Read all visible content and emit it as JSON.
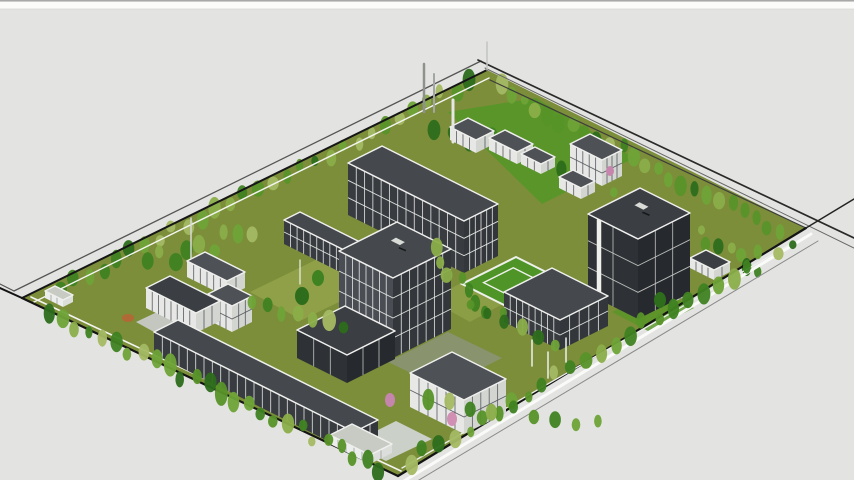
{
  "canvas": {
    "width": 854,
    "height": 480,
    "background": "#e3e4e1"
  },
  "topbar": {
    "height": 9,
    "fill": "#fbfbfa",
    "line": "#9c9c9c",
    "edge": "#d6d6d4"
  },
  "palette": {
    "boundary_black": "#141414",
    "road_gray": "#555555",
    "fence_white": "#f4f5f2",
    "roof_charcoal": "#45484d",
    "glazing_dark": "#383b40",
    "mullion_white": "#edefec",
    "lawn_olive": "#7c8e3a",
    "lawn_bright": "#579628",
    "lawn_light": "#9aab50",
    "pavement": "#c3c7c0",
    "plaza": "#cbd0c8",
    "tree_pink": "#c585ad",
    "tree_orange": "#b06a35"
  },
  "scene": {
    "site": {
      "outline": [
        [
          487,
          70
        ],
        [
          806,
          228
        ],
        [
          398,
          476
        ],
        [
          22,
          298
        ]
      ],
      "fill": "#7c8e3a",
      "bright": "#4f9427"
    },
    "tree_colors": [
      "#2d6d1b",
      "#3f8221",
      "#579428",
      "#6fa337",
      "#8bae49",
      "#a4b963"
    ],
    "styles": {
      "glass": {
        "roof": "#45484d",
        "wallL": "#383b40",
        "wallR": "#33363b",
        "line": "#edefec"
      },
      "dark": {
        "roof": "#3b3e43",
        "wallL": "#2e3136",
        "wallR": "#26292e",
        "line": "#c9cbc7"
      },
      "white": {
        "roof": "#4e5156",
        "wallL": "#e7e8e5",
        "wallR": "#d3d5d1",
        "line": "#50535a"
      },
      "light": {
        "roof": "#c7cbc4",
        "wallL": "#eceded",
        "wallR": "#dcdedb",
        "line": "#9a9e97"
      }
    },
    "patches": [
      {
        "name": "lawn-north-bright",
        "points": [
          [
            448,
            112
          ],
          [
            536,
            98
          ],
          [
            634,
            158
          ],
          [
            542,
            204
          ]
        ],
        "fill": "#579628",
        "opacity": 0.9
      },
      {
        "name": "lawn-west-light",
        "points": [
          [
            250,
            292
          ],
          [
            332,
            252
          ],
          [
            384,
            280
          ],
          [
            302,
            320
          ]
        ],
        "fill": "#9aab50",
        "opacity": 0.65
      },
      {
        "name": "lawn-mid-light",
        "points": [
          [
            430,
            300
          ],
          [
            470,
            278
          ],
          [
            510,
            300
          ],
          [
            470,
            322
          ]
        ],
        "fill": "#9aab50",
        "opacity": 0.5
      },
      {
        "name": "court-gray",
        "points": [
          [
            388,
            362
          ],
          [
            448,
            332
          ],
          [
            502,
            358
          ],
          [
            442,
            388
          ]
        ],
        "fill": "#8e947f",
        "opacity": 0.75
      },
      {
        "name": "plaza-south",
        "points": [
          [
            350,
            444
          ],
          [
            396,
            421
          ],
          [
            432,
            439
          ],
          [
            386,
            461
          ]
        ],
        "fill": "#cbd0c8",
        "opacity": 1
      },
      {
        "name": "pavement-west",
        "points": [
          [
            136,
            322
          ],
          [
            174,
            304
          ],
          [
            210,
            324
          ],
          [
            174,
            343
          ]
        ],
        "fill": "#c3c7c0",
        "opacity": 1
      },
      {
        "name": "lawn-east-bright",
        "points": [
          [
            612,
            312
          ],
          [
            658,
            288
          ],
          [
            694,
            308
          ],
          [
            648,
            331
          ]
        ],
        "fill": "#579628",
        "opacity": 0.8
      }
    ],
    "boundary": [
      {
        "name": "nw-road-outer",
        "pts": [
          [
            14,
            291
          ],
          [
            481,
            61
          ]
        ],
        "c": "#555555",
        "w": 1.3
      },
      {
        "name": "nw-fence",
        "pts": [
          [
            22,
            298
          ],
          [
            487,
            70
          ]
        ],
        "c": "#161616",
        "w": 2
      },
      {
        "name": "nw-fence-inner",
        "pts": [
          [
            32,
            303
          ],
          [
            489,
            78
          ]
        ],
        "c": "#f4f5f2",
        "w": 1.4
      },
      {
        "name": "ne-road-outer",
        "pts": [
          [
            478,
            60
          ],
          [
            854,
            238
          ]
        ],
        "c": "#2a2a2a",
        "w": 1.7
      },
      {
        "name": "ne-road-inner",
        "pts": [
          [
            485,
            68
          ],
          [
            854,
            248
          ]
        ],
        "c": "#666666",
        "w": 1
      },
      {
        "name": "ne-fence",
        "pts": [
          [
            490,
            80
          ],
          [
            806,
            228
          ]
        ],
        "c": "#3d3d3d",
        "w": 1.2
      },
      {
        "name": "se-fence",
        "pts": [
          [
            806,
            228
          ],
          [
            398,
            476
          ]
        ],
        "c": "#141414",
        "w": 2.2
      },
      {
        "name": "se-road-white",
        "pts": [
          [
            811,
            234
          ],
          [
            404,
            481
          ]
        ],
        "c": "#fafaf8",
        "w": 3
      },
      {
        "name": "se-road-outer",
        "pts": [
          [
            818,
            241
          ],
          [
            414,
            483
          ]
        ],
        "c": "#8a8a8a",
        "w": 1
      },
      {
        "name": "se-extension",
        "pts": [
          [
            806,
            228
          ],
          [
            854,
            199
          ]
        ],
        "c": "#222222",
        "w": 1.4
      },
      {
        "name": "sw-fence",
        "pts": [
          [
            22,
            298
          ],
          [
            398,
            476
          ]
        ],
        "c": "#141414",
        "w": 2.2
      },
      {
        "name": "sw-fence-inner",
        "pts": [
          [
            31,
            297
          ],
          [
            401,
            471
          ]
        ],
        "c": "#f4f5f2",
        "w": 1.6
      },
      {
        "name": "sw-extension",
        "pts": [
          [
            22,
            298
          ],
          [
            0,
            288
          ]
        ],
        "c": "#141414",
        "w": 2
      },
      {
        "name": "nw-ext-left",
        "pts": [
          [
            14,
            291
          ],
          [
            0,
            284
          ]
        ],
        "c": "#555555",
        "w": 1.2
      },
      {
        "name": "se-inner-path",
        "pts": [
          [
            796,
            241
          ],
          [
            402,
            468
          ]
        ],
        "c": "#eef0ec",
        "w": 1.3
      }
    ],
    "belts_back": [
      {
        "name": "belt-northwest",
        "x1": 60,
        "y1": 288,
        "x2": 470,
        "y2": 82,
        "n": 30,
        "j": 6,
        "rmin": 3.5,
        "rmax": 6.5,
        "seed": 11
      },
      {
        "name": "belt-northeast",
        "x1": 500,
        "y1": 88,
        "x2": 780,
        "y2": 232,
        "n": 24,
        "j": 6,
        "rmin": 3.5,
        "rmax": 6.5,
        "seed": 23
      },
      {
        "name": "grove-west",
        "x1": 148,
        "y1": 262,
        "x2": 252,
        "y2": 234,
        "n": 9,
        "j": 10,
        "rmin": 4,
        "rmax": 7,
        "seed": 31
      },
      {
        "name": "grove-north-lawn",
        "x1": 436,
        "y1": 124,
        "x2": 616,
        "y2": 186,
        "n": 11,
        "j": 9,
        "rmin": 3.5,
        "rmax": 6.5,
        "seed": 41
      },
      {
        "name": "grove-east",
        "x1": 700,
        "y1": 232,
        "x2": 756,
        "y2": 274,
        "n": 7,
        "j": 7,
        "rmin": 3.5,
        "rmax": 6.5,
        "seed": 53
      }
    ],
    "belts_front": [
      {
        "name": "belt-southwest",
        "x1": 50,
        "y1": 312,
        "x2": 380,
        "y2": 468,
        "n": 26,
        "j": 6,
        "rmin": 3.5,
        "rmax": 6.5,
        "seed": 61
      },
      {
        "name": "belt-southeast",
        "x1": 790,
        "y1": 240,
        "x2": 410,
        "y2": 462,
        "n": 27,
        "j": 6,
        "rmin": 3.5,
        "rmax": 6.5,
        "seed": 71
      },
      {
        "name": "grove-west-front",
        "x1": 252,
        "y1": 302,
        "x2": 342,
        "y2": 332,
        "n": 7,
        "j": 8,
        "rmin": 4,
        "rmax": 7,
        "seed": 83
      },
      {
        "name": "grove-center",
        "x1": 432,
        "y1": 252,
        "x2": 498,
        "y2": 318,
        "n": 8,
        "j": 8,
        "rmin": 3.5,
        "rmax": 6.5,
        "seed": 97
      },
      {
        "name": "grove-south",
        "x1": 428,
        "y1": 402,
        "x2": 598,
        "y2": 420,
        "n": 9,
        "j": 7,
        "rmin": 3.5,
        "rmax": 6.5,
        "seed": 103
      },
      {
        "name": "grove-courtyard-south",
        "x1": 472,
        "y1": 302,
        "x2": 556,
        "y2": 344,
        "n": 6,
        "j": 7,
        "rmin": 3.5,
        "rmax": 6,
        "seed": 113
      }
    ],
    "singles": [
      {
        "name": "pink-tree-1",
        "x": 390,
        "y": 400,
        "rx": 5,
        "ry": 7,
        "color": "#c585ad"
      },
      {
        "name": "pink-tree-2",
        "x": 452,
        "y": 419,
        "rx": 5,
        "ry": 7,
        "color": "#d18fb4"
      },
      {
        "name": "pink-tree-3",
        "x": 610,
        "y": 171,
        "rx": 4,
        "ry": 5,
        "color": "#c585ad"
      },
      {
        "name": "orange-tree",
        "x": 128,
        "y": 318,
        "rx": 6,
        "ry": 4,
        "color": "#b06a35"
      },
      {
        "name": "dark-tree-1",
        "x": 302,
        "y": 296,
        "rx": 7,
        "ry": 9,
        "color": "#2d6d1b"
      },
      {
        "name": "dark-tree-2",
        "x": 318,
        "y": 278,
        "rx": 6,
        "ry": 8,
        "color": "#3f8221"
      },
      {
        "name": "dark-tree-3",
        "x": 660,
        "y": 300,
        "rx": 6,
        "ry": 8,
        "color": "#2d6d1b"
      }
    ],
    "buildings": [
      {
        "name": "building-north-shed-a",
        "x": 468,
        "y": 118,
        "a": 13,
        "b": 9,
        "h": 13,
        "s": "white",
        "fl": 1,
        "mL": 4,
        "mR": 2
      },
      {
        "name": "building-north-shed-b",
        "x": 505,
        "y": 130,
        "a": 14,
        "b": 8,
        "h": 12,
        "s": "white",
        "fl": 1,
        "mL": 4,
        "mR": 2
      },
      {
        "name": "building-north-shed-c",
        "x": 535,
        "y": 147,
        "a": 10,
        "b": 7,
        "h": 10,
        "s": "white",
        "fl": 1,
        "mL": 3,
        "mR": 2
      },
      {
        "name": "building-northeast-lab",
        "x": 590,
        "y": 134,
        "a": 16,
        "b": 10,
        "h": 26,
        "s": "white",
        "fl": 2,
        "mL": 5,
        "mR": 4
      },
      {
        "name": "building-northeast-shed",
        "x": 573,
        "y": 170,
        "a": 11,
        "b": 7,
        "h": 11,
        "s": "white",
        "fl": 1,
        "mL": 3,
        "mR": 2
      },
      {
        "name": "building-glass-corridor",
        "x": 300,
        "y": 212,
        "a": 36,
        "b": 8,
        "h": 24,
        "s": "glass",
        "fl": 2,
        "mL": 11,
        "mR": 2
      },
      {
        "name": "building-north-glass-slab",
        "x": 382,
        "y": 146,
        "a": 58,
        "b": 17,
        "h": 52,
        "s": "glass",
        "fl": 3,
        "mL": 14,
        "mR": 6
      },
      {
        "name": "building-west-north-wing",
        "x": 205,
        "y": 252,
        "a": 20,
        "b": 9,
        "h": 16,
        "s": "white",
        "fl": 1,
        "mL": 6,
        "mR": 2
      },
      {
        "name": "building-east-row-north",
        "x": 706,
        "y": 250,
        "a": 12,
        "b": 8,
        "h": 10,
        "s": "white",
        "fl": 1,
        "mL": 4,
        "mR": 2,
        "roof": "#3b3e43"
      },
      {
        "name": "building-west-gatehouse",
        "x": 55,
        "y": 286,
        "a": 9,
        "b": 5,
        "h": 7,
        "s": "light",
        "fl": 1,
        "mL": 3,
        "mR": 1
      },
      {
        "name": "building-east-row-south",
        "x": 664,
        "y": 272,
        "a": 12,
        "b": 8,
        "h": 11,
        "s": "white",
        "fl": 1,
        "mL": 3,
        "mR": 2,
        "roof": "#3b3e43"
      },
      {
        "name": "building-west-pavilion",
        "x": 228,
        "y": 284,
        "a": 12,
        "b": 10,
        "h": 26,
        "s": "white",
        "fl": 2,
        "mL": 4,
        "mR": 3
      },
      {
        "name": "building-west-colonnade",
        "x": 170,
        "y": 276,
        "a": 25,
        "b": 12,
        "h": 20,
        "s": "white",
        "fl": 1,
        "mL": 8,
        "mR": 3,
        "roof": "#3b3e43"
      },
      {
        "name": "building-east-tower",
        "x": 640,
        "y": 188,
        "a": 25,
        "b": 26,
        "h": 80,
        "s": "dark",
        "fl": 3,
        "mL": 2,
        "mR": 3,
        "stripe": 0.22,
        "vent": 1
      },
      {
        "name": "building-courtyard-pergola",
        "type": "frame",
        "x": 516,
        "y": 257,
        "a": 21,
        "b": 27
      },
      {
        "name": "building-courtyard-wing",
        "x": 552,
        "y": 268,
        "a": 28,
        "b": 24,
        "h": 30,
        "s": "glass",
        "fl": 2,
        "mL": 9,
        "mR": 5
      },
      {
        "name": "building-central-tower",
        "x": 397,
        "y": 222,
        "a": 27,
        "b": 29,
        "h": 80,
        "s": "glass",
        "fl": 4,
        "mL": 8,
        "mR": 7,
        "wl": "#4a4e54",
        "vent": 1
      },
      {
        "name": "building-south-dark-box",
        "x": 345,
        "y": 306,
        "a": 25,
        "b": 24,
        "h": 28,
        "s": "dark",
        "fl": 1,
        "mL": 3,
        "mR": 3
      },
      {
        "name": "building-south-house",
        "x": 452,
        "y": 352,
        "a": 27,
        "b": 21,
        "h": 34,
        "s": "white",
        "fl": 2,
        "mL": 6,
        "mR": 5
      },
      {
        "name": "building-southwest-colonnade",
        "x": 178,
        "y": 320,
        "a": 100,
        "b": 12,
        "h": 22,
        "s": "glass",
        "fl": 1,
        "mL": 24,
        "mR": 3
      },
      {
        "name": "building-southwest-annex",
        "x": 352,
        "y": 424,
        "a": 20,
        "b": 11,
        "h": 9,
        "s": "light",
        "fl": 1,
        "mL": 5,
        "mR": 2
      }
    ],
    "poles": [
      {
        "name": "chimney-stack-white",
        "x1": 453,
        "y1": 100,
        "x2": 453,
        "y2": 142,
        "w": 3,
        "color": "#e6e7e4"
      },
      {
        "name": "chimney-stack-tall",
        "x1": 424,
        "y1": 64,
        "x2": 424,
        "y2": 112,
        "w": 2.5,
        "color": "#8e918e"
      },
      {
        "name": "chimney-stack-short",
        "x1": 434,
        "y1": 74,
        "x2": 434,
        "y2": 112,
        "w": 2,
        "color": "#a2a5a2"
      },
      {
        "name": "mast-west",
        "x1": 191,
        "y1": 218,
        "x2": 191,
        "y2": 258,
        "w": 1.5,
        "color": "#d8dad6"
      },
      {
        "name": "mast-apex",
        "x1": 487,
        "y1": 42,
        "x2": 487,
        "y2": 70,
        "w": 1.5,
        "color": "#c2c4c1"
      },
      {
        "name": "lamp-post-1",
        "x1": 532,
        "y1": 340,
        "x2": 532,
        "y2": 366,
        "w": 1.5,
        "color": "#eef0ec"
      },
      {
        "name": "lamp-post-2",
        "x1": 548,
        "y1": 352,
        "x2": 548,
        "y2": 378,
        "w": 1.5,
        "color": "#eef0ec"
      },
      {
        "name": "lamp-post-3",
        "x1": 566,
        "y1": 338,
        "x2": 566,
        "y2": 362,
        "w": 1.5,
        "color": "#eef0ec"
      },
      {
        "name": "lamp-post-4",
        "x1": 300,
        "y1": 260,
        "x2": 300,
        "y2": 284,
        "w": 1.2,
        "color": "#eef0ec"
      }
    ]
  }
}
